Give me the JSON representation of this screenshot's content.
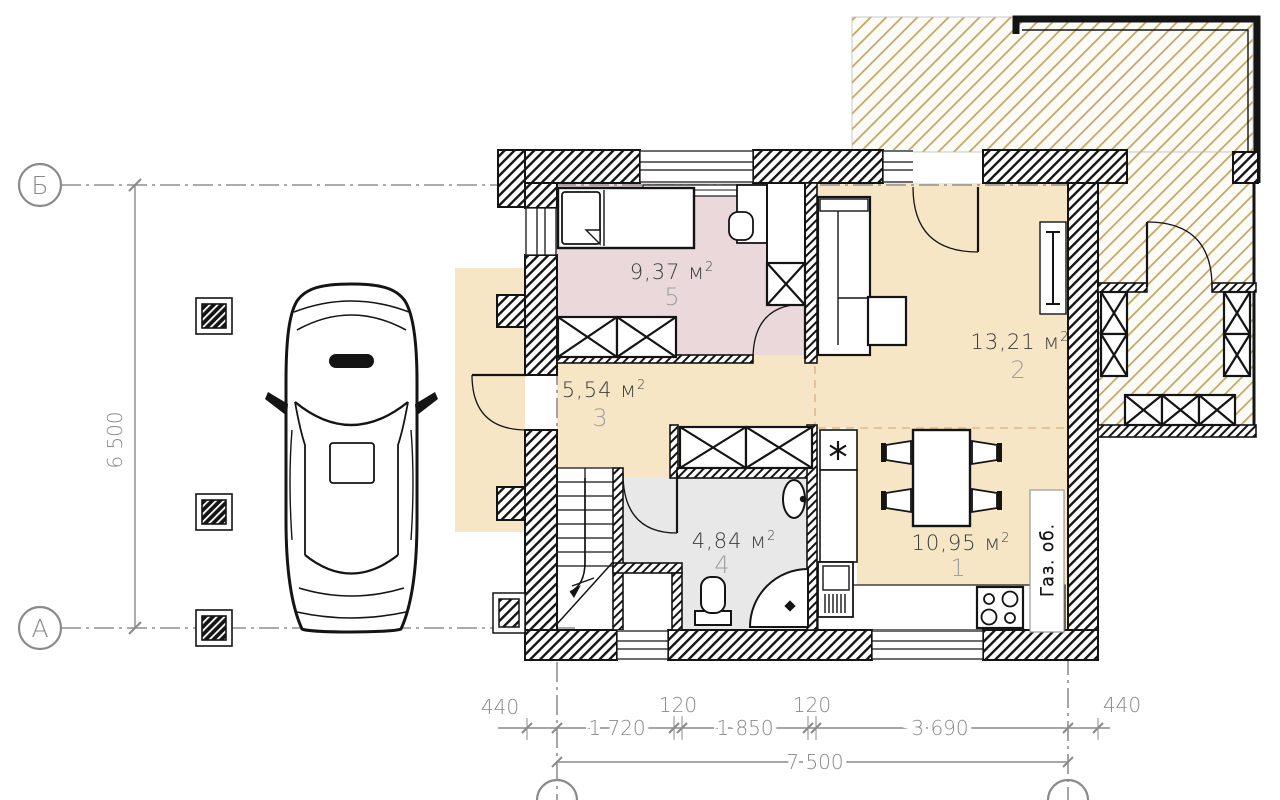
{
  "rooms": [
    {
      "number": "1",
      "area": "10,95 м",
      "sup": "2"
    },
    {
      "number": "2",
      "area": "13,21 м",
      "sup": "2"
    },
    {
      "number": "3",
      "area": "5,54 м",
      "sup": "2"
    },
    {
      "number": "4",
      "area": "4,84 м",
      "sup": "2"
    },
    {
      "number": "5",
      "area": "9,37 м",
      "sup": "2"
    }
  ],
  "axes": {
    "top": "Б",
    "bottom": "А"
  },
  "dimensions": {
    "row1": [
      "440",
      "1 720",
      "120",
      "1 850",
      "120",
      "3 690",
      "440"
    ],
    "total": "7 500",
    "height": "6 500"
  },
  "annotations": {
    "gas": "Газ. об."
  },
  "colors": {
    "wall": "#141414",
    "floor": "#f6e6c5",
    "bedroom": "#ead8da",
    "bathroom": "#e8e8e8",
    "terrace_hatch": "#c7a763",
    "dimension": "#8a8a8a"
  }
}
